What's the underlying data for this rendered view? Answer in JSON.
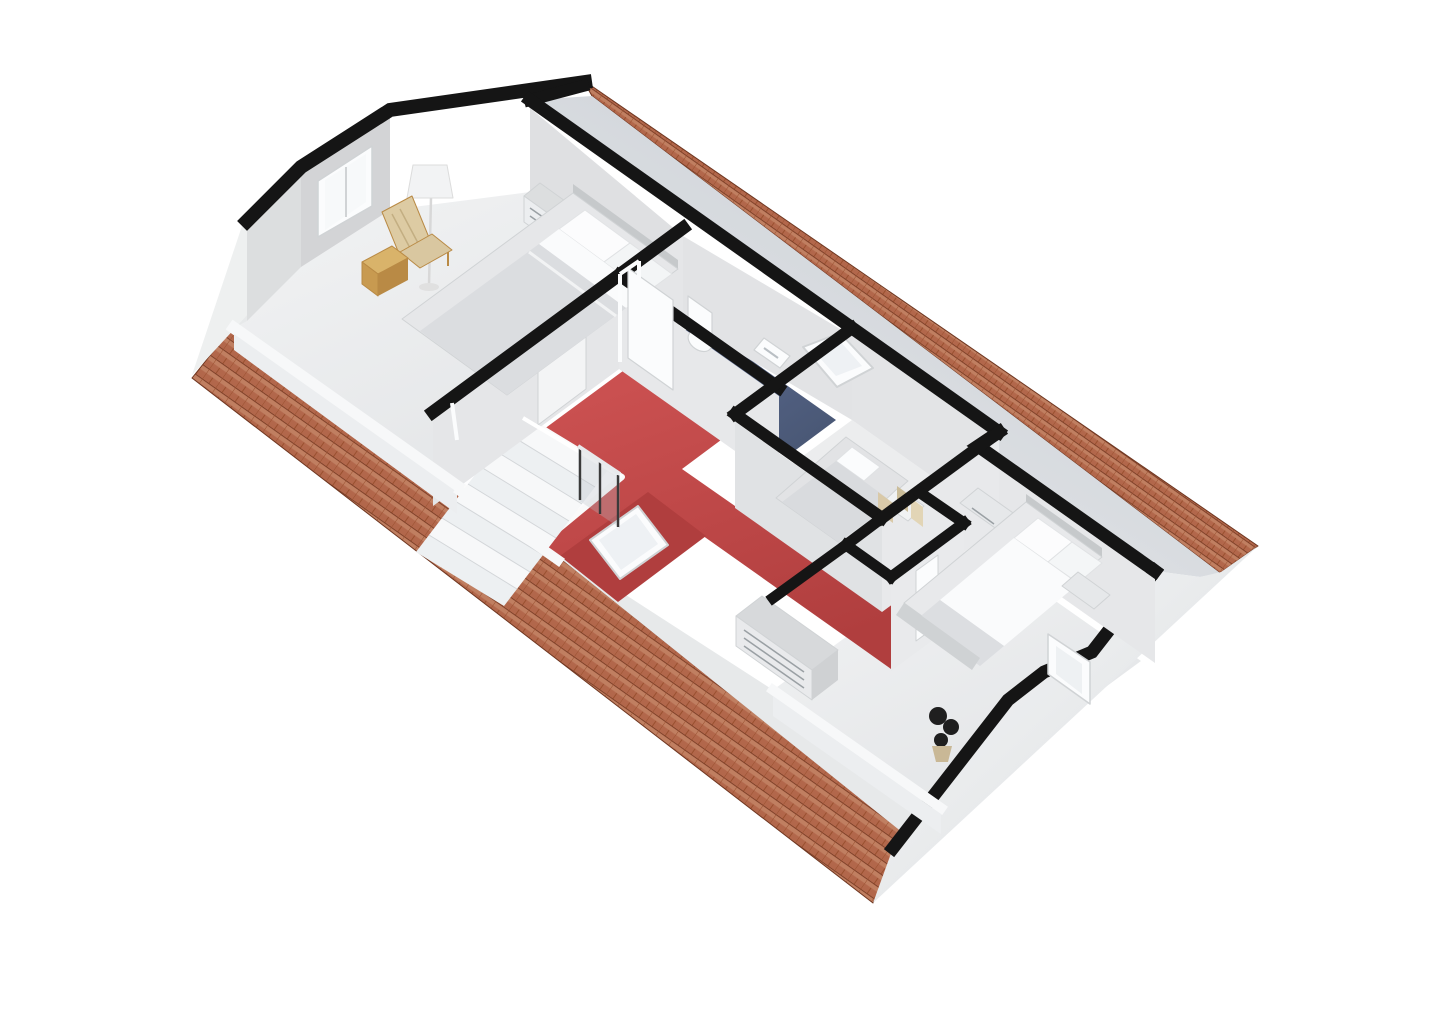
{
  "meta": {
    "kind": "3d-floor-plan-render",
    "view": "isometric-birdseye",
    "floor_name": "attic floor",
    "background": "#ffffff"
  },
  "palette": {
    "bg": "#ffffff",
    "ink": "#151515",
    "tileBase": "#b2674b",
    "tileDark": "#6e3620",
    "tileMid": "#99502f",
    "tileLight": "#cb9372",
    "slopeA": "#c2c7ce",
    "slopeB": "#ebedef",
    "wedgeA": "#f5f6f7",
    "wedgeB": "#dcdfe1",
    "wallFace": "#e3e4e6",
    "wallLight": "#e8e9eb",
    "wallMid": "#d8dadc",
    "wallDark": "#c6c9cb",
    "floorA": "#f1f2f3",
    "floorB": "#e3e5e7",
    "floorPlain": "#ecedee",
    "red": "#c74b4b",
    "redDark": "#b03e3e",
    "blue": "#55648c",
    "blueDark": "#475571",
    "white": "#fbfcfd",
    "offWhite": "#f3f4f5",
    "trim": "#d0d3d5",
    "wood": "#d9b36a",
    "woodDark": "#b98a45",
    "woodSeat": "#ddcba3",
    "plant": "#1f1f1f",
    "pot": "#c9b896",
    "glass": "#b9c0c6",
    "ext": "#eef0f0",
    "knee": "#f7f8f9",
    "picA": "#d9c9a8",
    "picB": "#e2d5b6",
    "picC": "#cbbd9a"
  },
  "rooms": [
    {
      "id": "master-bedroom",
      "label": "bedroom (north-west)",
      "floor": "floorA"
    },
    {
      "id": "landing-hall",
      "label": "landing / hallway",
      "floor": "red"
    },
    {
      "id": "bathroom",
      "label": "bathroom",
      "floor": "blue"
    },
    {
      "id": "small-bedroom",
      "label": "small bedroom",
      "floor": "floorPlain"
    },
    {
      "id": "bedroom-2",
      "label": "bedroom (south-east)",
      "floor": "floorPlain"
    }
  ],
  "features": {
    "roof": {
      "material": "terracotta-tiles",
      "color": "tileBase"
    },
    "cut_walls": {
      "color": "ink"
    },
    "stairs": {
      "treads": 8,
      "railing_posts": 3
    },
    "skylights": 2,
    "windows": 2,
    "doors": 4
  },
  "furniture": {
    "master-bedroom": [
      "double-bed",
      "pillows",
      "nightstand",
      "floor-lamp",
      "wooden-chair",
      "wooden-cabinet",
      "window"
    ],
    "landing-hall": [
      "staircase",
      "railing",
      "skylight"
    ],
    "bathroom": [
      "toilet",
      "sink",
      "door"
    ],
    "small-bedroom": [
      "single-bed",
      "skylight"
    ],
    "bedroom-2": [
      "double-bed",
      "two-nightstands",
      "chest-of-drawers",
      "wall-pictures",
      "black-plant",
      "dormer-window"
    ]
  }
}
